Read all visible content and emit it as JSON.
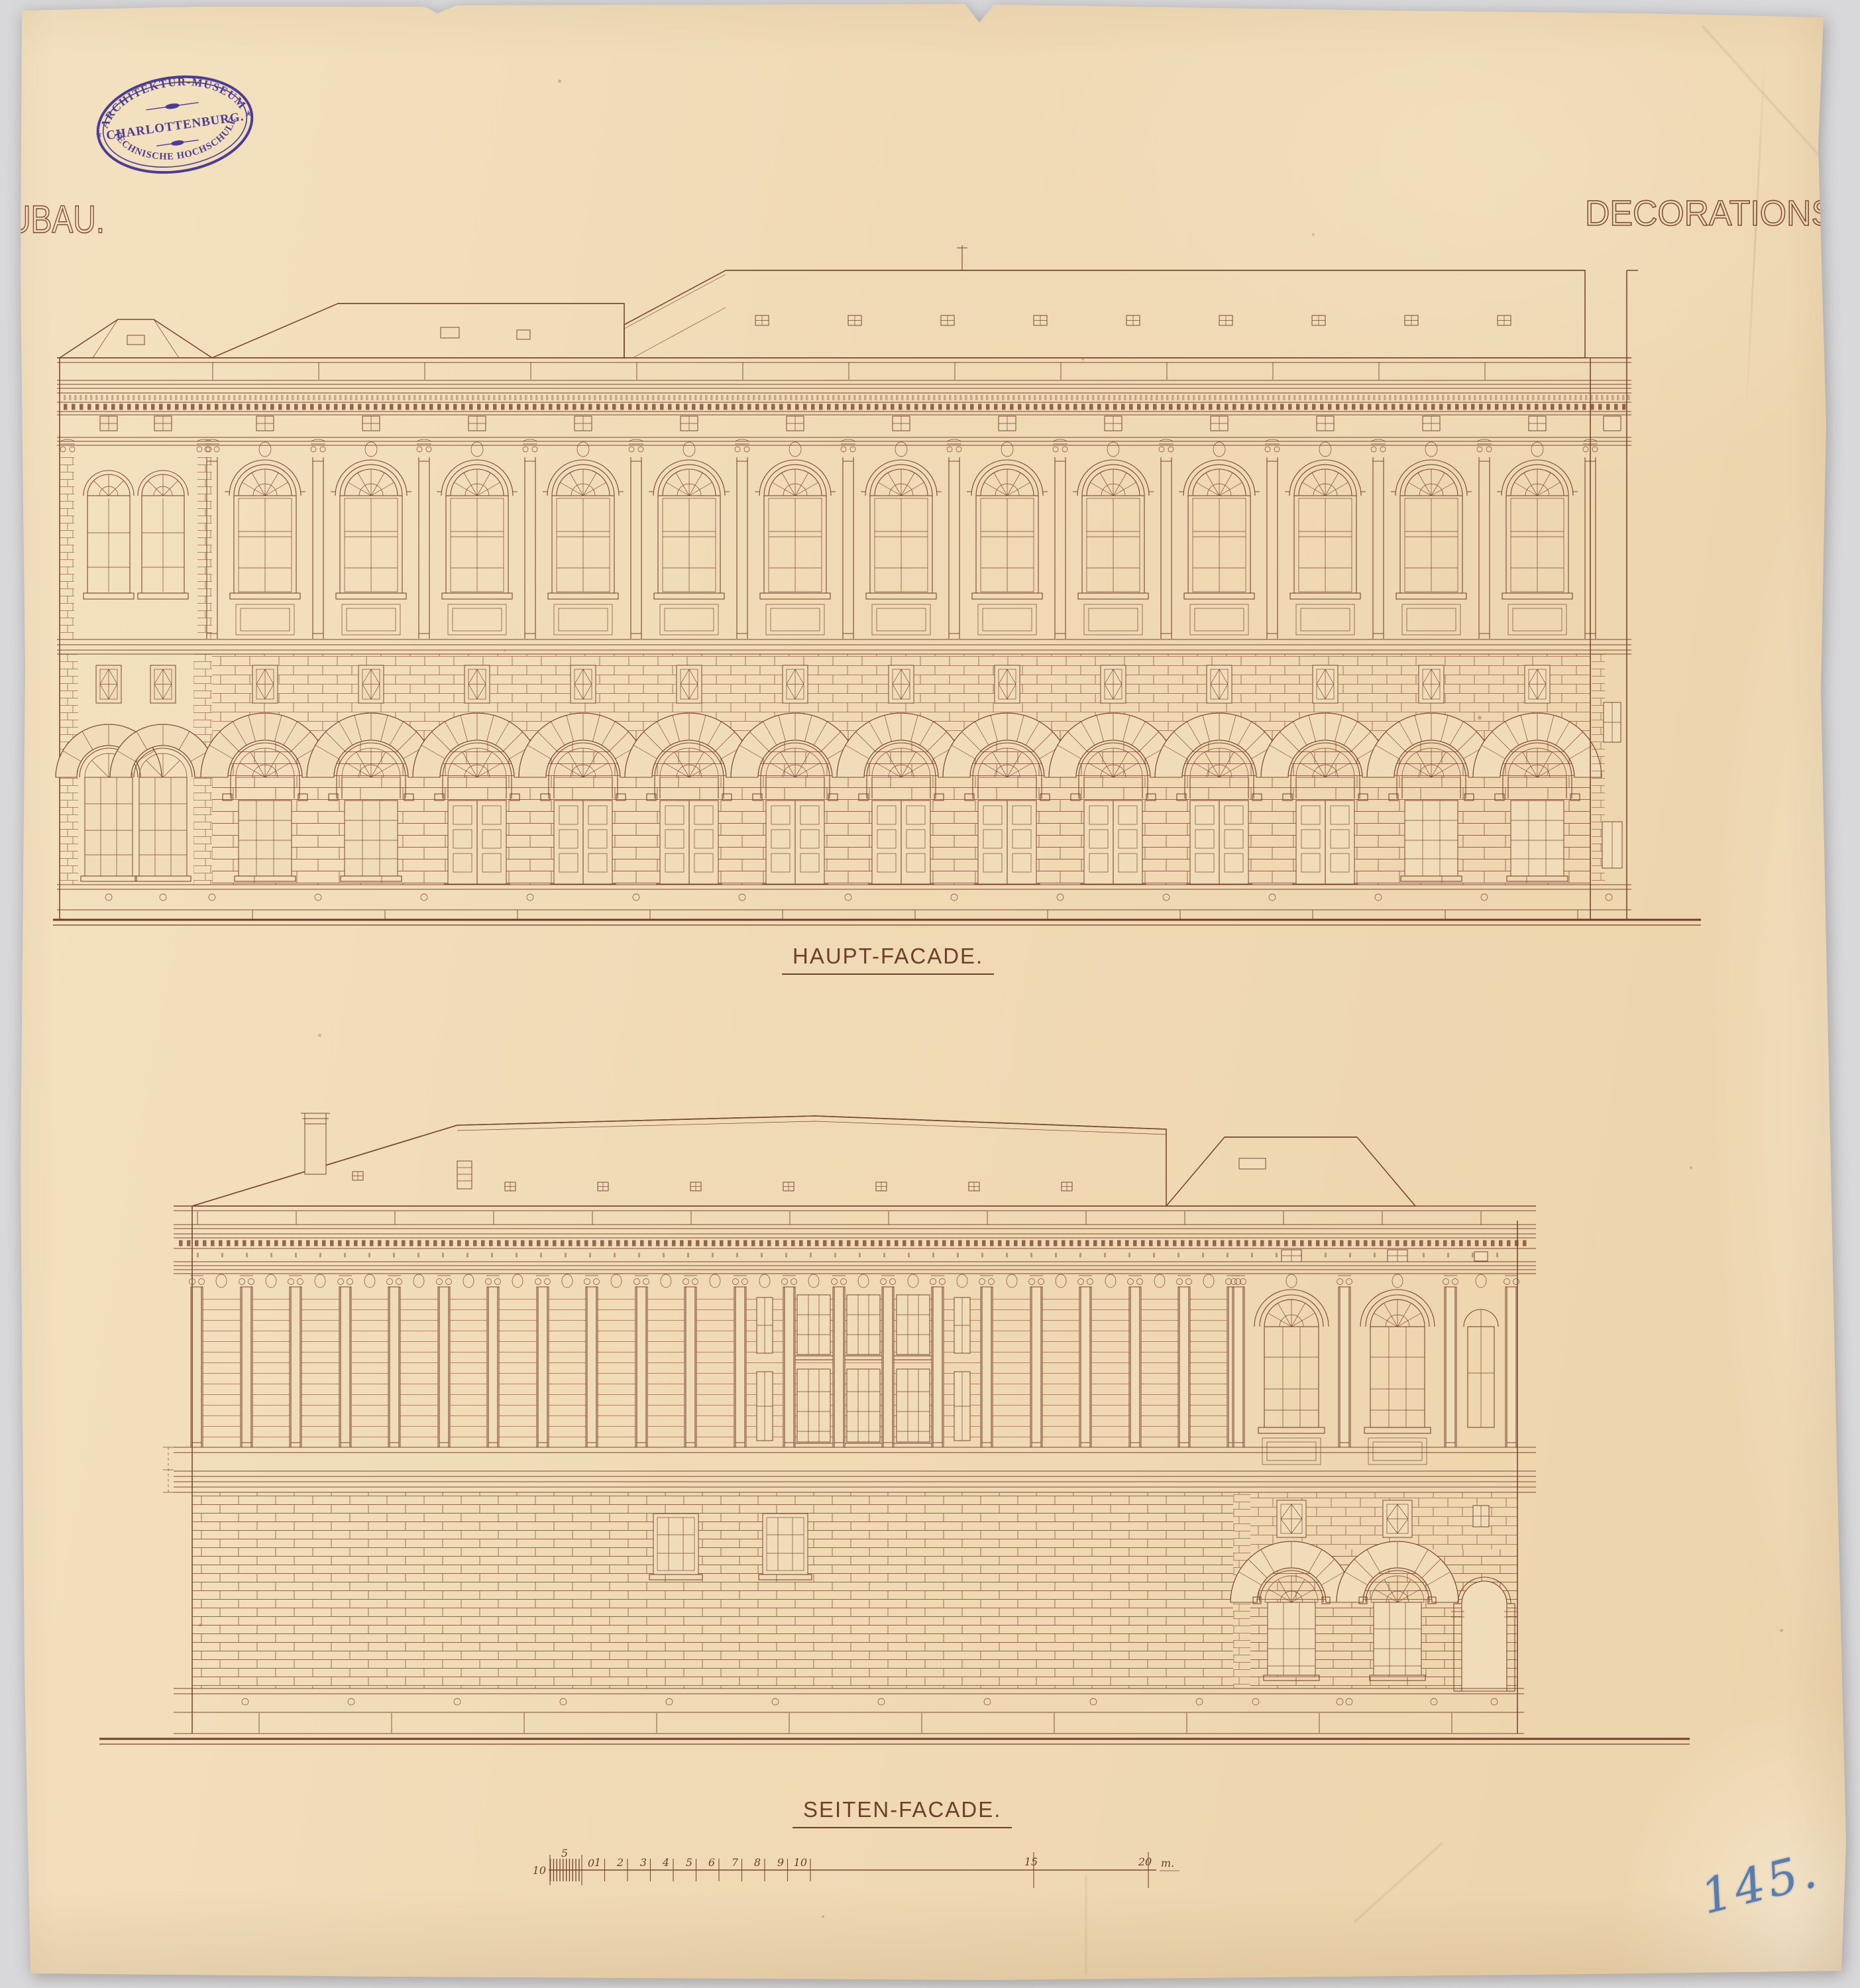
{
  "page": {
    "background_color": "#d8d8db",
    "paper_color": "#f1dcba",
    "ink_color": "#7a4733",
    "stamp_color": "#4c3d92",
    "pencil_color": "#3f6dab"
  },
  "stamp": {
    "arc_top": "ARCHITEKTUR-MUSEUM",
    "center": "CHARLOTTENBURG.",
    "arc_bottom": "TECHNISCHE HOCHSCHULE."
  },
  "titles": {
    "left_partial": "UBAU.",
    "right": "DECORATIONS"
  },
  "drawings": {
    "main": {
      "caption": "HAUPT-FACADE."
    },
    "side": {
      "caption": "SEITEN-FACADE."
    }
  },
  "scale_bar": {
    "tick_labels": [
      "10",
      "5",
      "0",
      "1",
      "2",
      "3",
      "4",
      "5",
      "6",
      "7",
      "8",
      "9",
      "10",
      "15",
      "20"
    ],
    "unit_label": "m."
  },
  "annotations": {
    "archive_number": "145."
  }
}
